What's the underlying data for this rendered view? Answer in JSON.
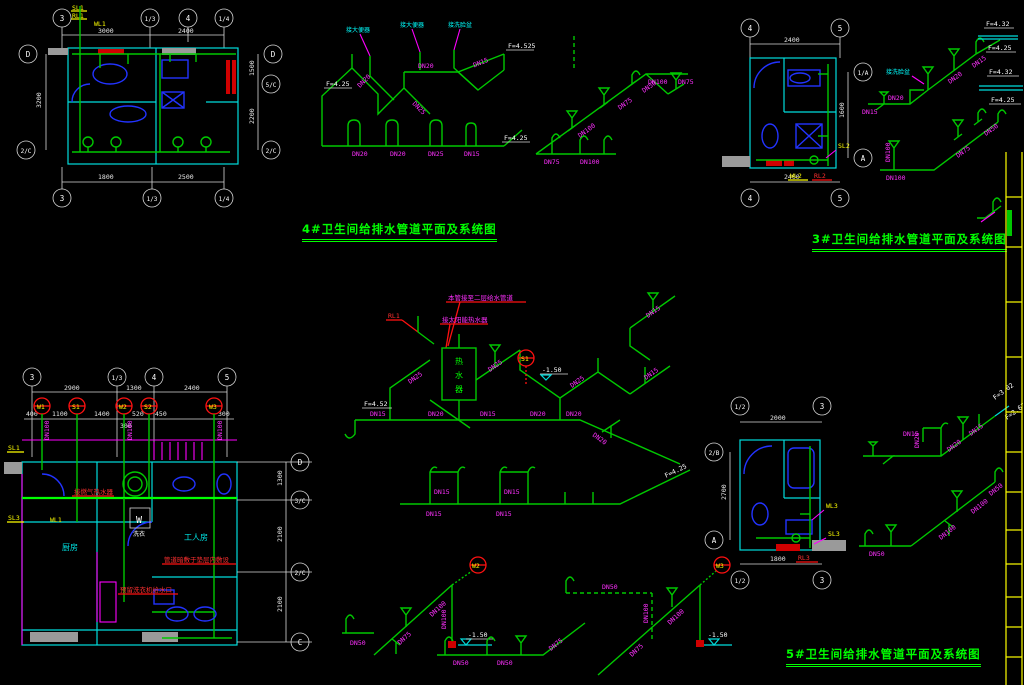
{
  "colors": {
    "pipe_green": "#00c800",
    "bright_green": "#00ff00",
    "label_magenta": "#ff30ff",
    "wall_cyan": "#00dcdc",
    "fixture_blue": "#2233ff",
    "hot_red": "#ff1111",
    "riser_yellow": "#ffff00",
    "dim_white": "#e8e8e8",
    "border_yellow": "#ffff00",
    "background": "#000000"
  },
  "titles": {
    "t4": "4#卫生间给排水管道平面及系统图",
    "t3": "3#卫生间给排水管道平面及系统图",
    "t5": "5#卫生间给排水管道平面及系统图"
  },
  "plan4": {
    "grid_top": [
      "3",
      "1/3",
      "4",
      "1/4"
    ],
    "grid_bottom": [
      "3",
      "1/3",
      "1/4"
    ],
    "grid_left": [
      "D",
      "2/C"
    ],
    "grid_right": [
      "D",
      "5/C",
      "2/C"
    ],
    "dims_top": [
      "3000",
      "2400"
    ],
    "dims_bottom": [
      "1800",
      "2500"
    ],
    "dim_left": "3200",
    "dims_right": [
      "1500",
      "2200"
    ],
    "risers": [
      "SL1",
      "RL1",
      "WL1"
    ]
  },
  "iso4s": {
    "fixtures": [
      "接大便器",
      "接大便器",
      "接洗脸盆"
    ],
    "dn": [
      "DN20",
      "DN25",
      "DN20",
      "DN15",
      "DN20",
      "DN20",
      "DN25",
      "DN15"
    ],
    "elev": [
      "F=4.25",
      "F=4.525",
      "F=4.25"
    ]
  },
  "iso4d": {
    "dn": [
      "DN100",
      "DN75",
      "DN50",
      "DN100",
      "DN75",
      "DN100",
      "DN75"
    ]
  },
  "plan3": {
    "grid_top": [
      "4",
      "5"
    ],
    "grid_bottom": [
      "4",
      "5"
    ],
    "grid_right": [
      "1/A",
      "A"
    ],
    "dim_top": "2400",
    "dim_bottom": "2400",
    "dim_right": "1600",
    "risers": [
      "SL2",
      "WL2",
      "RL2"
    ]
  },
  "iso3s": {
    "fixture": "接洗脸盆",
    "dn": [
      "DN20",
      "DN15",
      "DN20",
      "DN15"
    ],
    "elev": [
      "F=4.32",
      "F=4.25"
    ]
  },
  "iso3d": {
    "dn": [
      "DN75",
      "DN50",
      "DN100",
      "DN100"
    ]
  },
  "plan5L": {
    "grid_top": [
      "3",
      "1/3",
      "4",
      "5"
    ],
    "dims_top": [
      "2900",
      "1300",
      "2400"
    ],
    "subdims": [
      "400",
      "1100",
      "1400",
      "520",
      "450",
      "300"
    ],
    "subdim2": "300",
    "riser_marks": [
      "W1",
      "S1",
      "W2",
      "S2",
      "W3"
    ],
    "pipes_dn": [
      "DN100",
      "DN100",
      "DN100"
    ],
    "grid_right": [
      "D",
      "3/C",
      "2/C",
      "C"
    ],
    "dims_right": [
      "1300",
      "2100",
      "2100"
    ],
    "rooms": {
      "kitchen": "厨房",
      "worker": "工人房",
      "laundry": "洗衣",
      "w": "W"
    },
    "risers": [
      "SL1",
      "SL3",
      "WL1"
    ],
    "annotations": [
      "接燃气热水器",
      "管道暗敷于垫层内敷设",
      "预留洗衣机给水口"
    ]
  },
  "iso5s": {
    "riser": "RL1",
    "heater": [
      "热",
      "水",
      "器"
    ],
    "mark": "S1",
    "dn": [
      "DN15",
      "DN25",
      "DN25",
      "DN20",
      "DN15",
      "DN20",
      "DN20",
      "DN20",
      "DN25",
      "DN15",
      "DN15"
    ],
    "elev": [
      "F=4.52",
      "-1.50"
    ],
    "annotations": [
      "本管接至二层给水管道",
      "接太阳能热水器"
    ]
  },
  "iso5row": {
    "dn": [
      "DN15",
      "DN15",
      "DN15",
      "DN15"
    ],
    "elev": "F=4.25"
  },
  "isoW2": {
    "mark": "W2",
    "dn": [
      "DN50",
      "DN75",
      "DN100",
      "DN100"
    ],
    "elev": "-1.50"
  },
  "isoW3": {
    "mark": "W3",
    "dn": [
      "DN50",
      "DN100",
      "DN75",
      "DN100"
    ],
    "elev": "-1.50"
  },
  "isoSmall": {
    "dn": [
      "DN50",
      "DN50",
      "DN75"
    ]
  },
  "plan5": {
    "grid_top": [
      "1/2",
      "3"
    ],
    "grid_bottom": [
      "1/2",
      "3"
    ],
    "grid_left": [
      "2/B",
      "A"
    ],
    "dim_top": "2000",
    "dim_bottom": "1800",
    "dim_left": "2700",
    "risers": [
      "WL3",
      "SL3",
      "RL3"
    ]
  },
  "iso5rs": {
    "dn": [
      "DN15",
      "DN20",
      "DN15",
      "DN20"
    ],
    "elev": [
      "F=3.02",
      "F=2.62"
    ]
  },
  "iso5rd": {
    "dn": [
      "DN50",
      "DN100",
      "DN100",
      "DN50"
    ]
  },
  "legend": {
    "elev": [
      "F=4.32",
      "F=4.25"
    ]
  }
}
